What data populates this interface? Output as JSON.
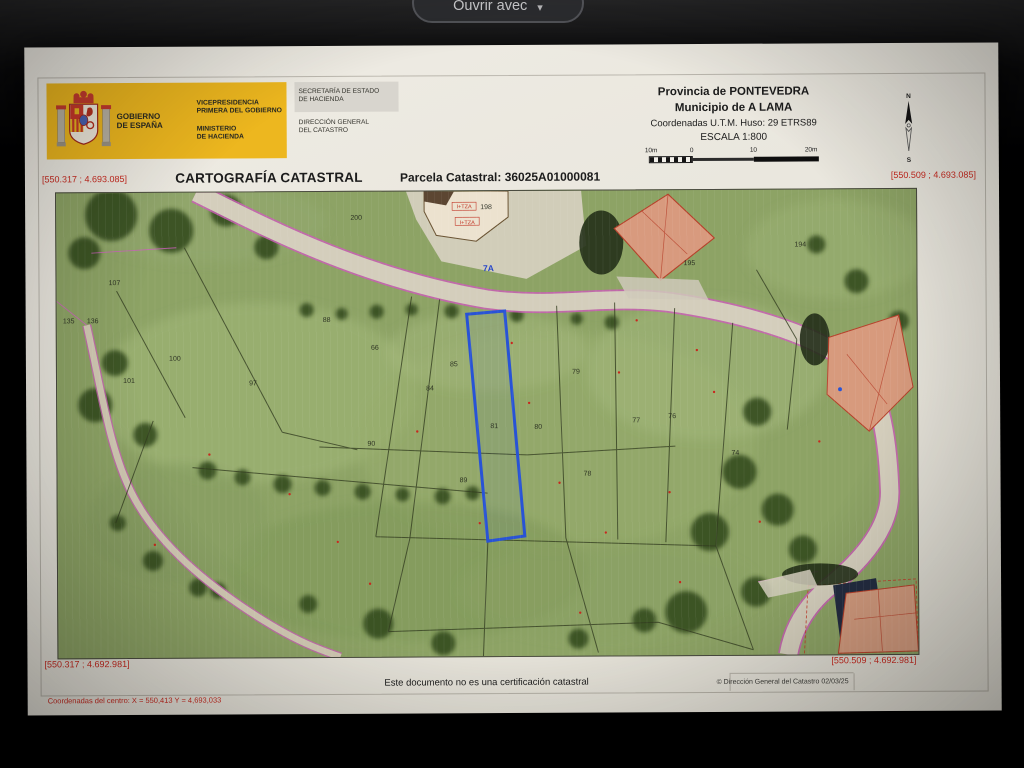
{
  "toolbar": {
    "open_with": "Ouvrir avec",
    "chevron": "▾"
  },
  "header": {
    "logo": {
      "gobierno_l1": "GOBIERNO",
      "gobierno_l2": "DE ESPAÑA",
      "vice_l1": "VICEPRESIDENCIA",
      "vice_l2": "PRIMERA DEL GOBIERNO",
      "min_l1": "MINISTERIO",
      "min_l2": "DE HACIENDA",
      "sec_l1": "SECRETARÍA DE ESTADO",
      "sec_l2": "DE HACIENDA",
      "dir_l1": "DIRECCIÓN GENERAL",
      "dir_l2": "DEL CATASTRO"
    },
    "province": "Provincia de PONTEVEDRA",
    "municipality": "Municipio de A LAMA",
    "utm": "Coordenadas U.T.M. Huso: 29 ETRS89",
    "scale_label": "ESCALA 1:800",
    "scale_ticks": [
      "10m",
      "0",
      "10",
      "20m"
    ],
    "compass_n": "N",
    "compass_s": "S"
  },
  "title_row": {
    "coord_top_left": "[550.317 ; 4.693.085]",
    "title": "CARTOGRAFÍA CATASTRAL",
    "parcel_ref": "Parcela Catastral: 36025A01000081",
    "coord_top_right": "[550.509 ; 4.693.085]"
  },
  "map": {
    "coord_bottom_left": "[550.317 ; 4.692.981]",
    "coord_bottom_right": "[550.509 ; 4.692.981]",
    "highlighted_parcel": "81",
    "road_label": "7A",
    "building_labels": [
      {
        "t": "I+TZA",
        "x": 408,
        "y": 17
      },
      {
        "t": "I+TZA",
        "x": 411,
        "y": 33
      }
    ],
    "parcel_labels": [
      {
        "t": "200",
        "x": 300,
        "y": 28
      },
      {
        "t": "198",
        "x": 430,
        "y": 18
      },
      {
        "t": "195",
        "x": 633,
        "y": 75
      },
      {
        "t": "194",
        "x": 744,
        "y": 57
      },
      {
        "t": "107",
        "x": 58,
        "y": 92
      },
      {
        "t": "135",
        "x": 12,
        "y": 130
      },
      {
        "t": "136",
        "x": 36,
        "y": 130
      },
      {
        "t": "100",
        "x": 118,
        "y": 168
      },
      {
        "t": "101",
        "x": 72,
        "y": 190
      },
      {
        "t": "97",
        "x": 196,
        "y": 193
      },
      {
        "t": "88",
        "x": 270,
        "y": 130
      },
      {
        "t": "66",
        "x": 318,
        "y": 158
      },
      {
        "t": "90",
        "x": 314,
        "y": 254
      },
      {
        "t": "85",
        "x": 397,
        "y": 175
      },
      {
        "t": "84",
        "x": 373,
        "y": 199
      },
      {
        "t": "81",
        "x": 437,
        "y": 237
      },
      {
        "t": "80",
        "x": 481,
        "y": 238
      },
      {
        "t": "79",
        "x": 519,
        "y": 183
      },
      {
        "t": "78",
        "x": 530,
        "y": 285
      },
      {
        "t": "77",
        "x": 579,
        "y": 232
      },
      {
        "t": "76",
        "x": 615,
        "y": 228
      },
      {
        "t": "74",
        "x": 678,
        "y": 265
      },
      {
        "t": "89",
        "x": 406,
        "y": 291
      },
      {
        "t": "7A",
        "x": 432,
        "y": 80,
        "c": "b"
      }
    ],
    "red_marks": [
      [
        455,
        152
      ],
      [
        472,
        212
      ],
      [
        502,
        292
      ],
      [
        548,
        342
      ],
      [
        422,
        332
      ],
      [
        562,
        182
      ],
      [
        612,
        302
      ],
      [
        657,
        202
      ],
      [
        232,
        302
      ],
      [
        152,
        262
      ],
      [
        97,
        352
      ],
      [
        702,
        332
      ],
      [
        762,
        252
      ],
      [
        312,
        392
      ],
      [
        522,
        422
      ],
      [
        622,
        392
      ],
      [
        580,
        130
      ],
      [
        640,
        160
      ],
      [
        360,
        240
      ],
      [
        280,
        350
      ]
    ]
  },
  "footer": {
    "disclaimer": "Este documento no es una certificación catastral",
    "copyright": "© Dirección General del Catastro 02/03/25",
    "center_coords": "Coordenadas del centro: X = 550,413 Y = 4,693,033"
  },
  "colors": {
    "accent_yellow": "#edb71f",
    "coord_red": "#c8281e",
    "parcel_blue": "#2853d6",
    "magenta_line": "#c95fb5"
  }
}
